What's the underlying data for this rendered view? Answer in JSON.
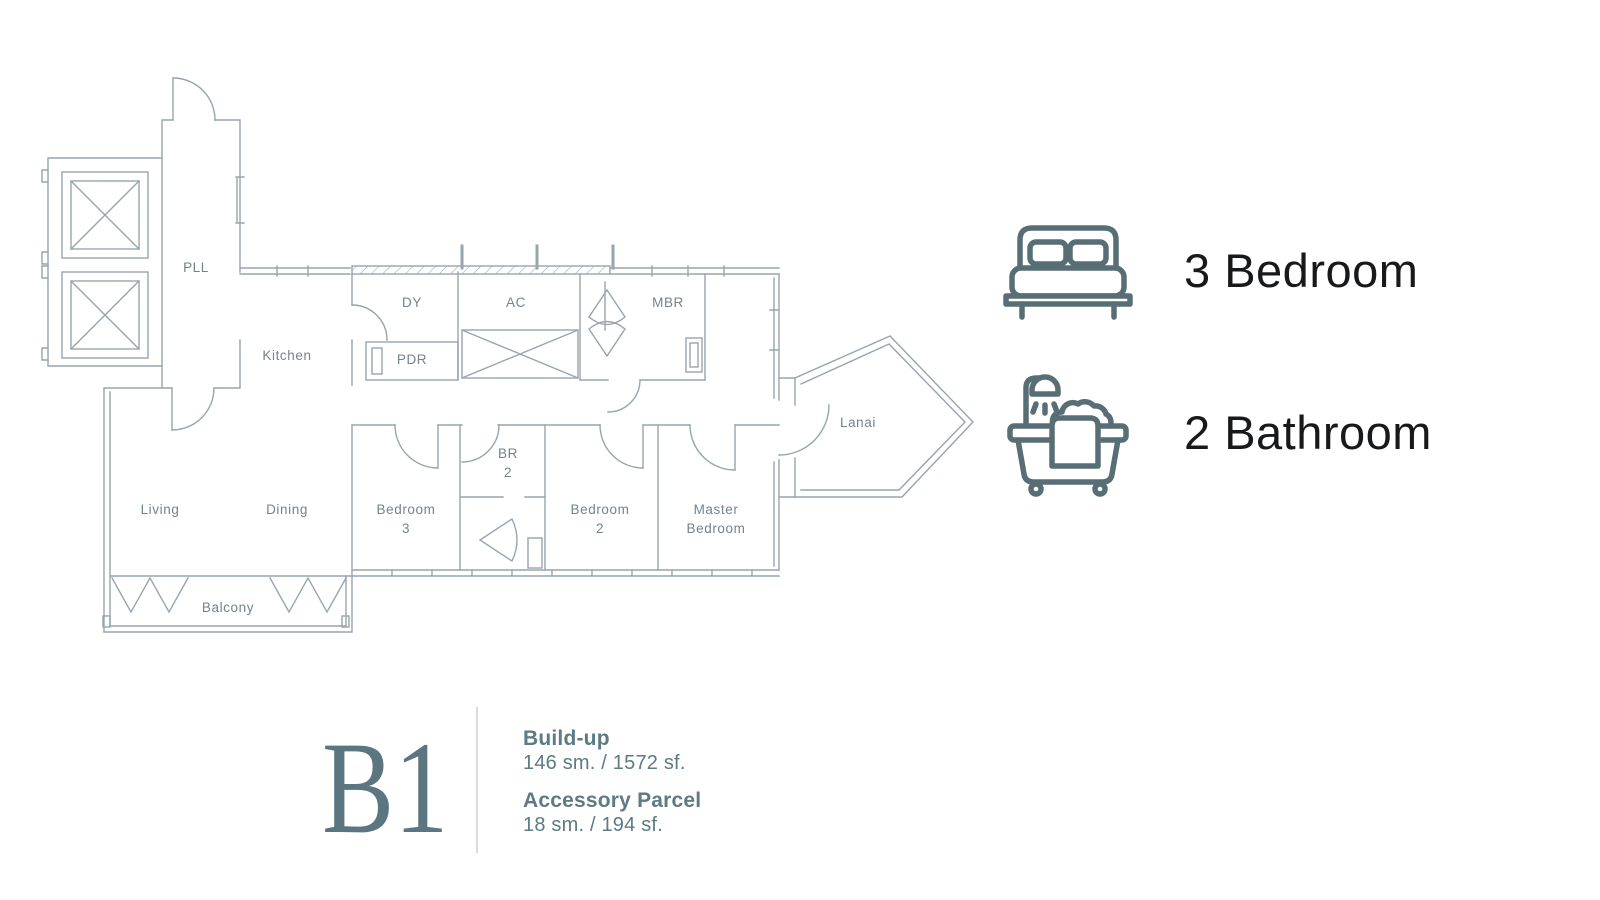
{
  "plan": {
    "line_color": "#96A5AE",
    "label_color": "#75838B",
    "labels": {
      "pll": "PLL",
      "kitchen": "Kitchen",
      "dy": "DY",
      "pdr": "PDR",
      "ac": "AC",
      "mbr": "MBR",
      "br2_l1": "BR",
      "br2_l2": "2",
      "living": "Living",
      "dining": "Dining",
      "bedroom3_l1": "Bedroom",
      "bedroom3_l2": "3",
      "bedroom2_l1": "Bedroom",
      "bedroom2_l2": "2",
      "master_l1": "Master",
      "master_l2": "Bedroom",
      "lanai": "Lanai",
      "balcony": "Balcony"
    }
  },
  "features": {
    "icon_color": "#586E75",
    "text_color": "#17191B",
    "bedrooms": {
      "icon": "bed-icon",
      "label": "3 Bedroom"
    },
    "bathrooms": {
      "icon": "bathtub-icon",
      "label": "2 Bathroom"
    }
  },
  "unit": {
    "code": "B1",
    "accent_color": "#5B7680",
    "details_color": "#5C7B84",
    "build_up": {
      "label": "Build-up",
      "value": "146 sm. / 1572 sf."
    },
    "accessory_parcel": {
      "label": "Accessory Parcel",
      "value": "18 sm. / 194 sf."
    }
  }
}
